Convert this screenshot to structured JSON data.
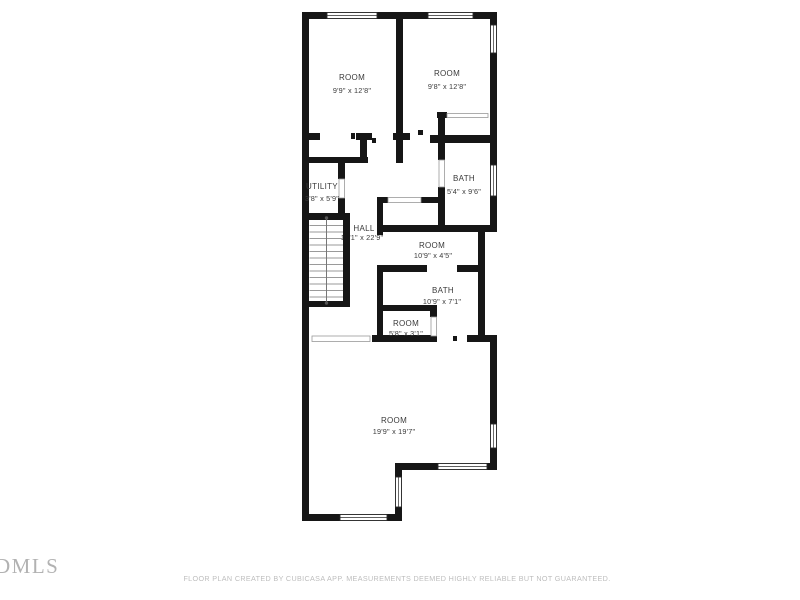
{
  "floor_plan": {
    "rooms": [
      {
        "id": "room-top-left",
        "name": "ROOM",
        "dimensions": "9'9\" x 12'8\""
      },
      {
        "id": "room-top-right",
        "name": "ROOM",
        "dimensions": "9'8\" x 12'8\""
      },
      {
        "id": "utility",
        "name": "UTILITY",
        "dimensions": "3'8\" x 5'9\""
      },
      {
        "id": "bath-upper",
        "name": "BATH",
        "dimensions": "5'4\" x 9'6\""
      },
      {
        "id": "hall",
        "name": "HALL",
        "dimensions": "10'1\" x 22'9\""
      },
      {
        "id": "room-middle",
        "name": "ROOM",
        "dimensions": "10'9\" x 4'5\""
      },
      {
        "id": "bath-lower",
        "name": "BATH",
        "dimensions": "10'9\" x 7'1\""
      },
      {
        "id": "room-small",
        "name": "ROOM",
        "dimensions": "5'8\" x 3'1\""
      },
      {
        "id": "room-large",
        "name": "ROOM",
        "dimensions": "19'9\" x 19'7\""
      }
    ],
    "features": [
      "stairs",
      "windows",
      "door-openings"
    ]
  },
  "watermark": {
    "logo_text": "DMLS"
  },
  "footer": {
    "disclaimer": "FLOOR PLAN CREATED BY CUBICASA APP. MEASUREMENTS DEEMED HIGHLY RELIABLE BUT NOT GUARANTEED."
  },
  "colors": {
    "wall": "#161616",
    "label": "#3a3a3a",
    "muted_text": "#bdbdbd",
    "logo": "#b2b2b2",
    "background": "#ffffff"
  }
}
